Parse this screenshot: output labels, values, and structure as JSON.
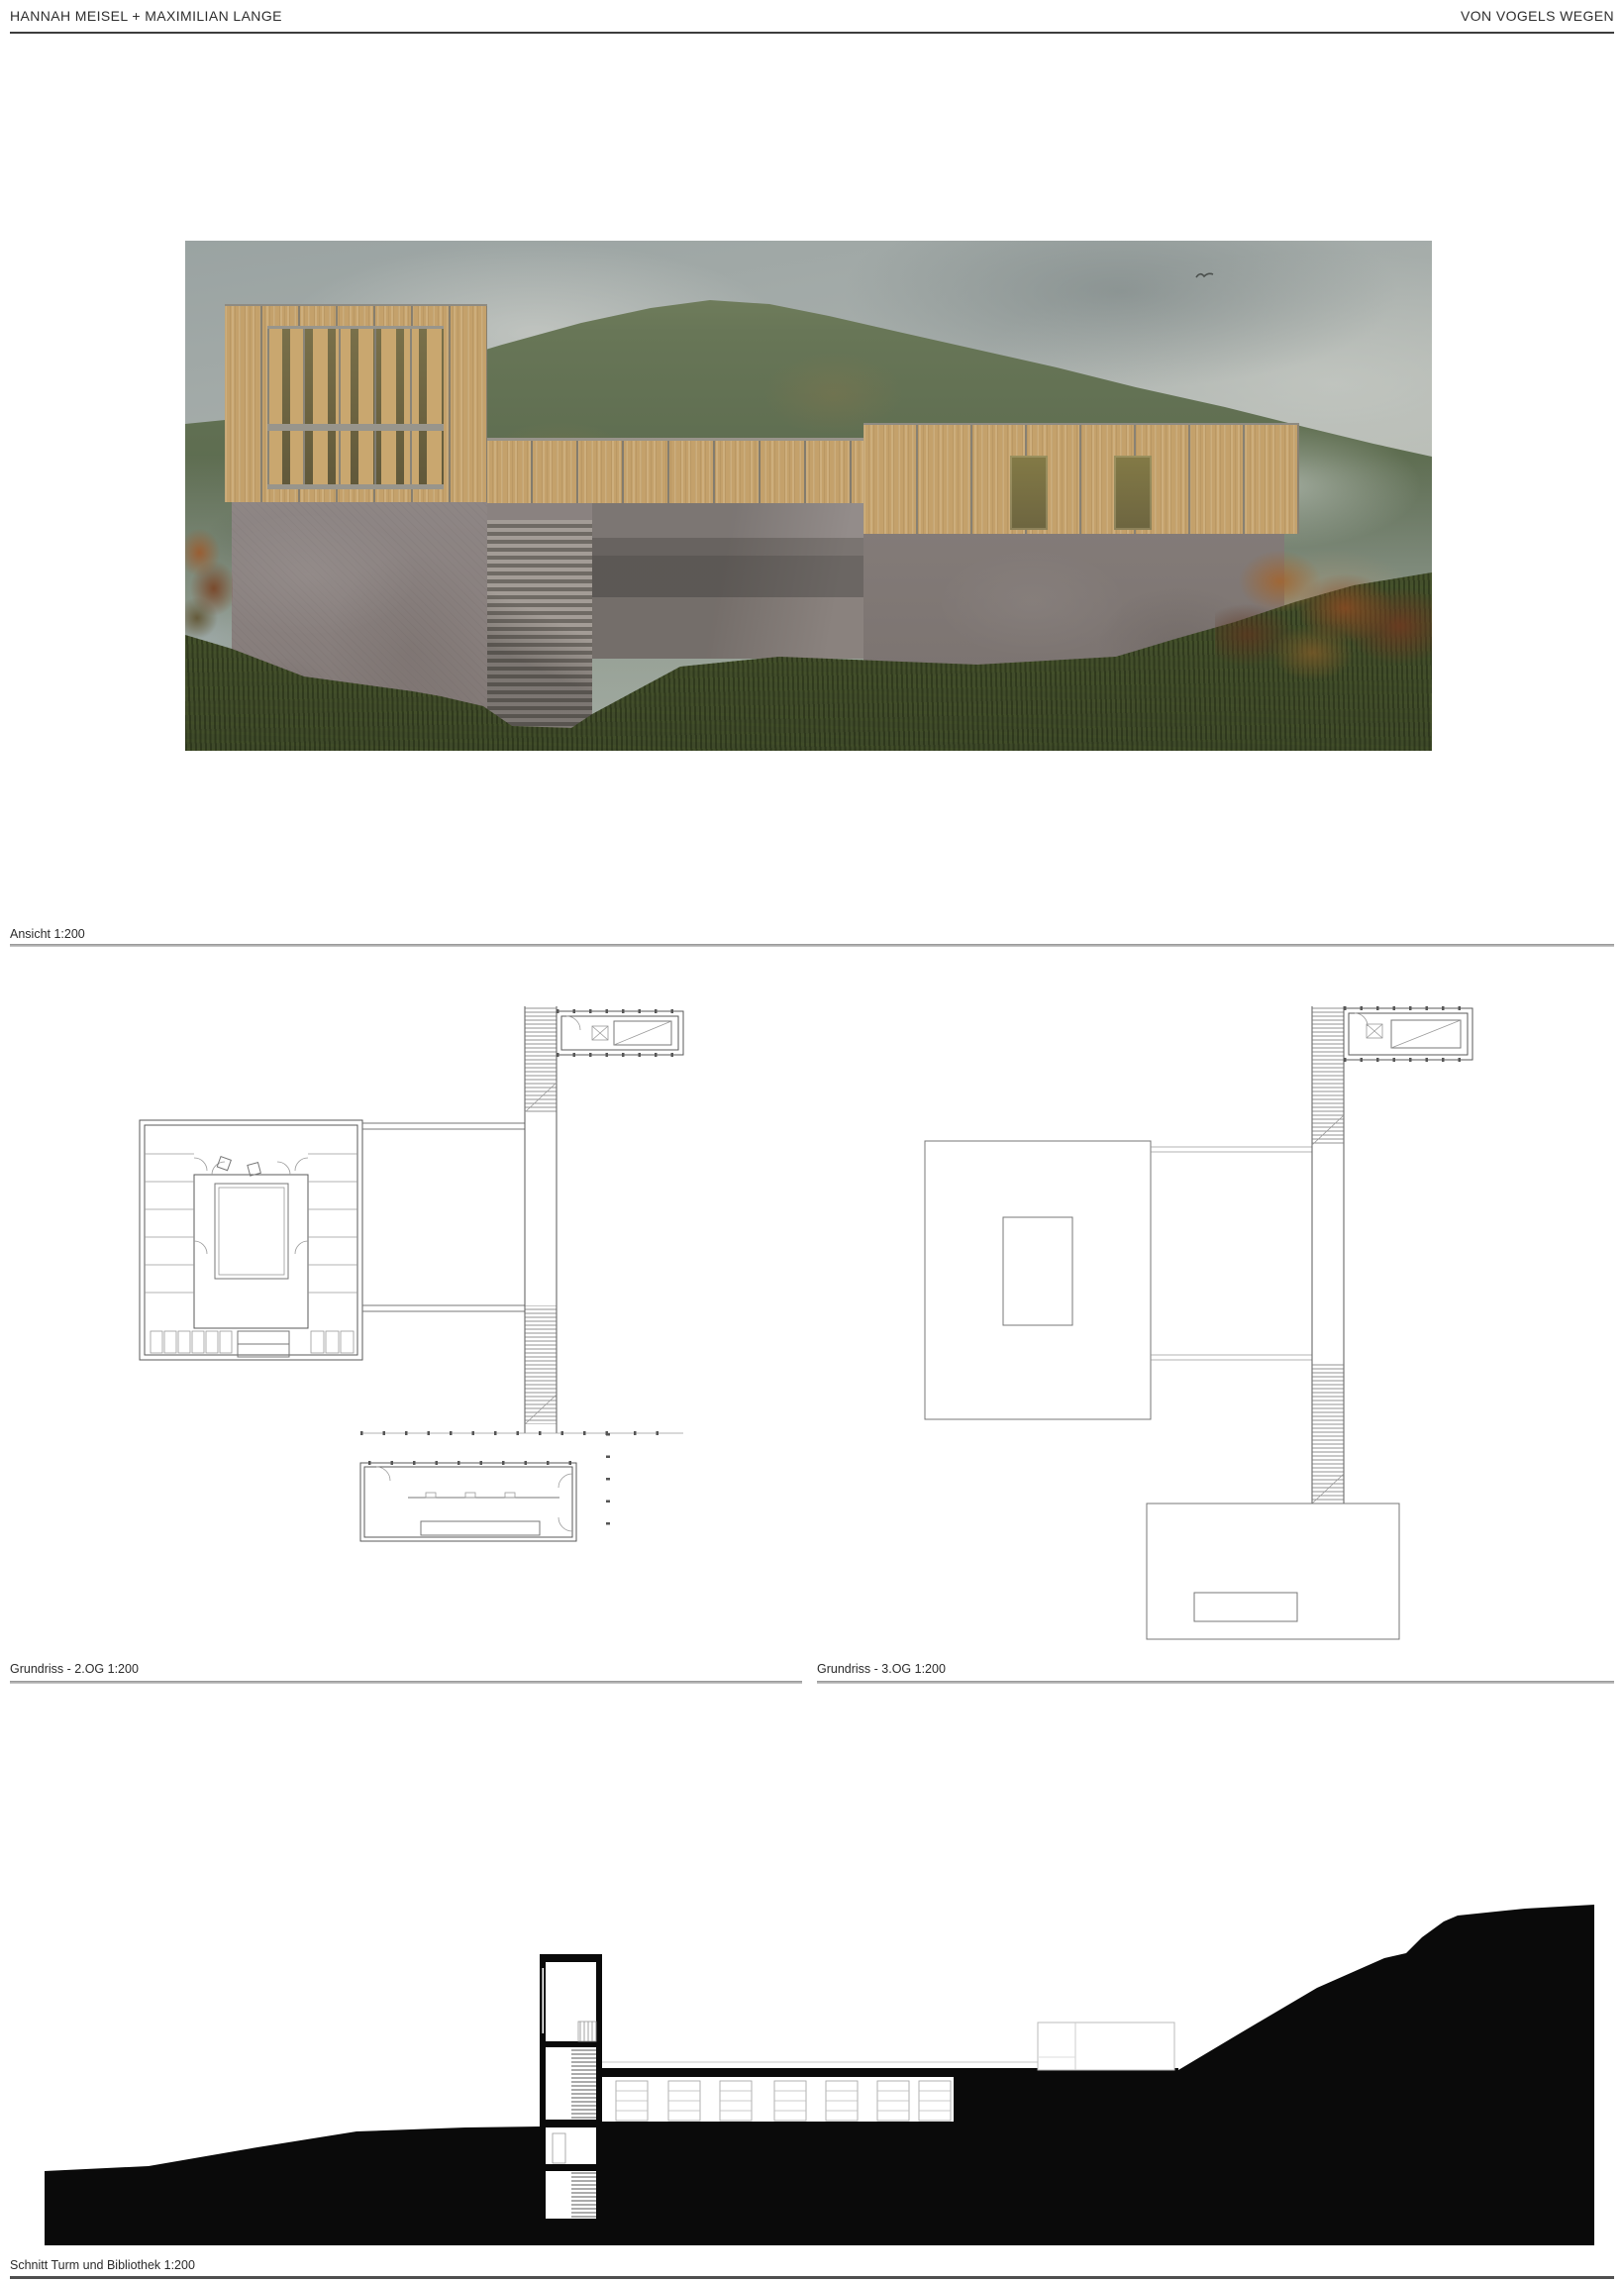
{
  "header": {
    "left": "HANNAH MEISEL + MAXIMILIAN LANGE",
    "right": "VON VOGELS WEGEN"
  },
  "figures": {
    "rendering": {
      "caption": "Ansicht 1:200",
      "type": "elevation collage rendering"
    },
    "plan_2og": {
      "caption": "Grundriss - 2.OG 1:200",
      "type": "floor plan"
    },
    "plan_3og": {
      "caption": "Grundriss - 3.OG 1:200",
      "type": "floor plan"
    },
    "section": {
      "caption": "Schnitt Turm und Bibliothek 1:200",
      "type": "section drawing"
    }
  },
  "icons": {
    "bird": "bird-icon"
  },
  "colors": {
    "page_bg": "#ffffff",
    "header_rule": "#3d3d3d",
    "caption_rule": "#9e9e9e",
    "bottom_rule": "#4f4f4f",
    "wood_facade": "#c4a16b",
    "window_olive": "#6e6542",
    "concrete": "#8c8483",
    "sky": "#a9b0ac",
    "hill_green": "#5e6c50",
    "grass_foreground": "#46522d",
    "autumn_shrub": "#a4642c",
    "section_poche": "#0a0a0a"
  }
}
